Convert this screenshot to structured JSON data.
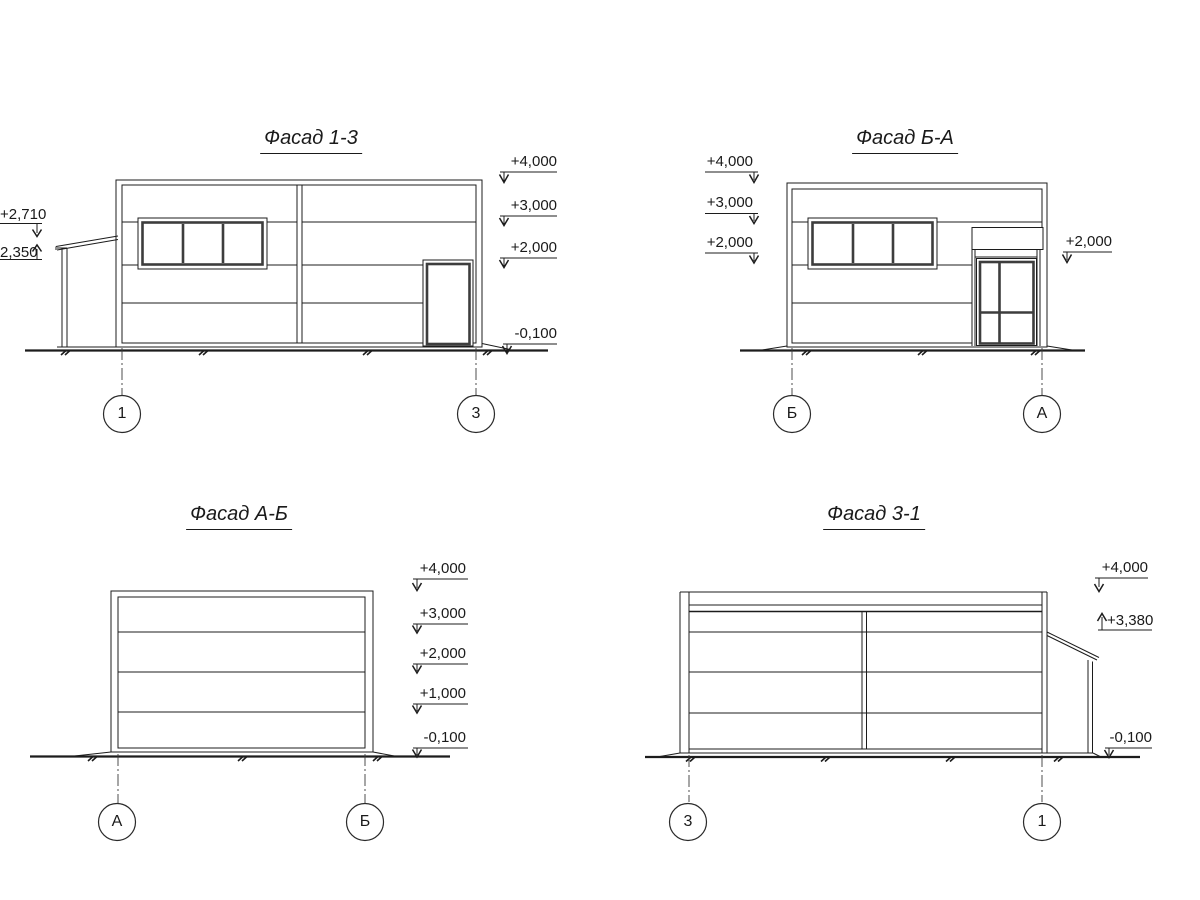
{
  "colors": {
    "background": "#ffffff",
    "line": "#1c1c1c",
    "frame": "#3d3d3d"
  },
  "facades": [
    {
      "title": "Фасад 1-3",
      "axis_left": "1",
      "axis_right": "3",
      "elevations_left": [
        "+2,710",
        "2,350"
      ],
      "elevations_right": [
        "+4,000",
        "+3,000",
        "+2,000",
        "-0,100"
      ]
    },
    {
      "title": "Фасад Б-А",
      "axis_left": "Б",
      "axis_right": "А",
      "elevations_left": [
        "+4,000",
        "+3,000",
        "+2,000"
      ],
      "elevations_right": [
        "+2,000"
      ]
    },
    {
      "title": "Фасад А-Б",
      "axis_left": "А",
      "axis_right": "Б",
      "elevations_left": [],
      "elevations_right": [
        "+4,000",
        "+3,000",
        "+2,000",
        "+1,000",
        "-0,100"
      ]
    },
    {
      "title": "Фасад 3-1",
      "axis_left": "3",
      "axis_right": "1",
      "elevations_left": [],
      "elevations_right": [
        "+4,000",
        "+3,380",
        "-0,100"
      ]
    }
  ]
}
